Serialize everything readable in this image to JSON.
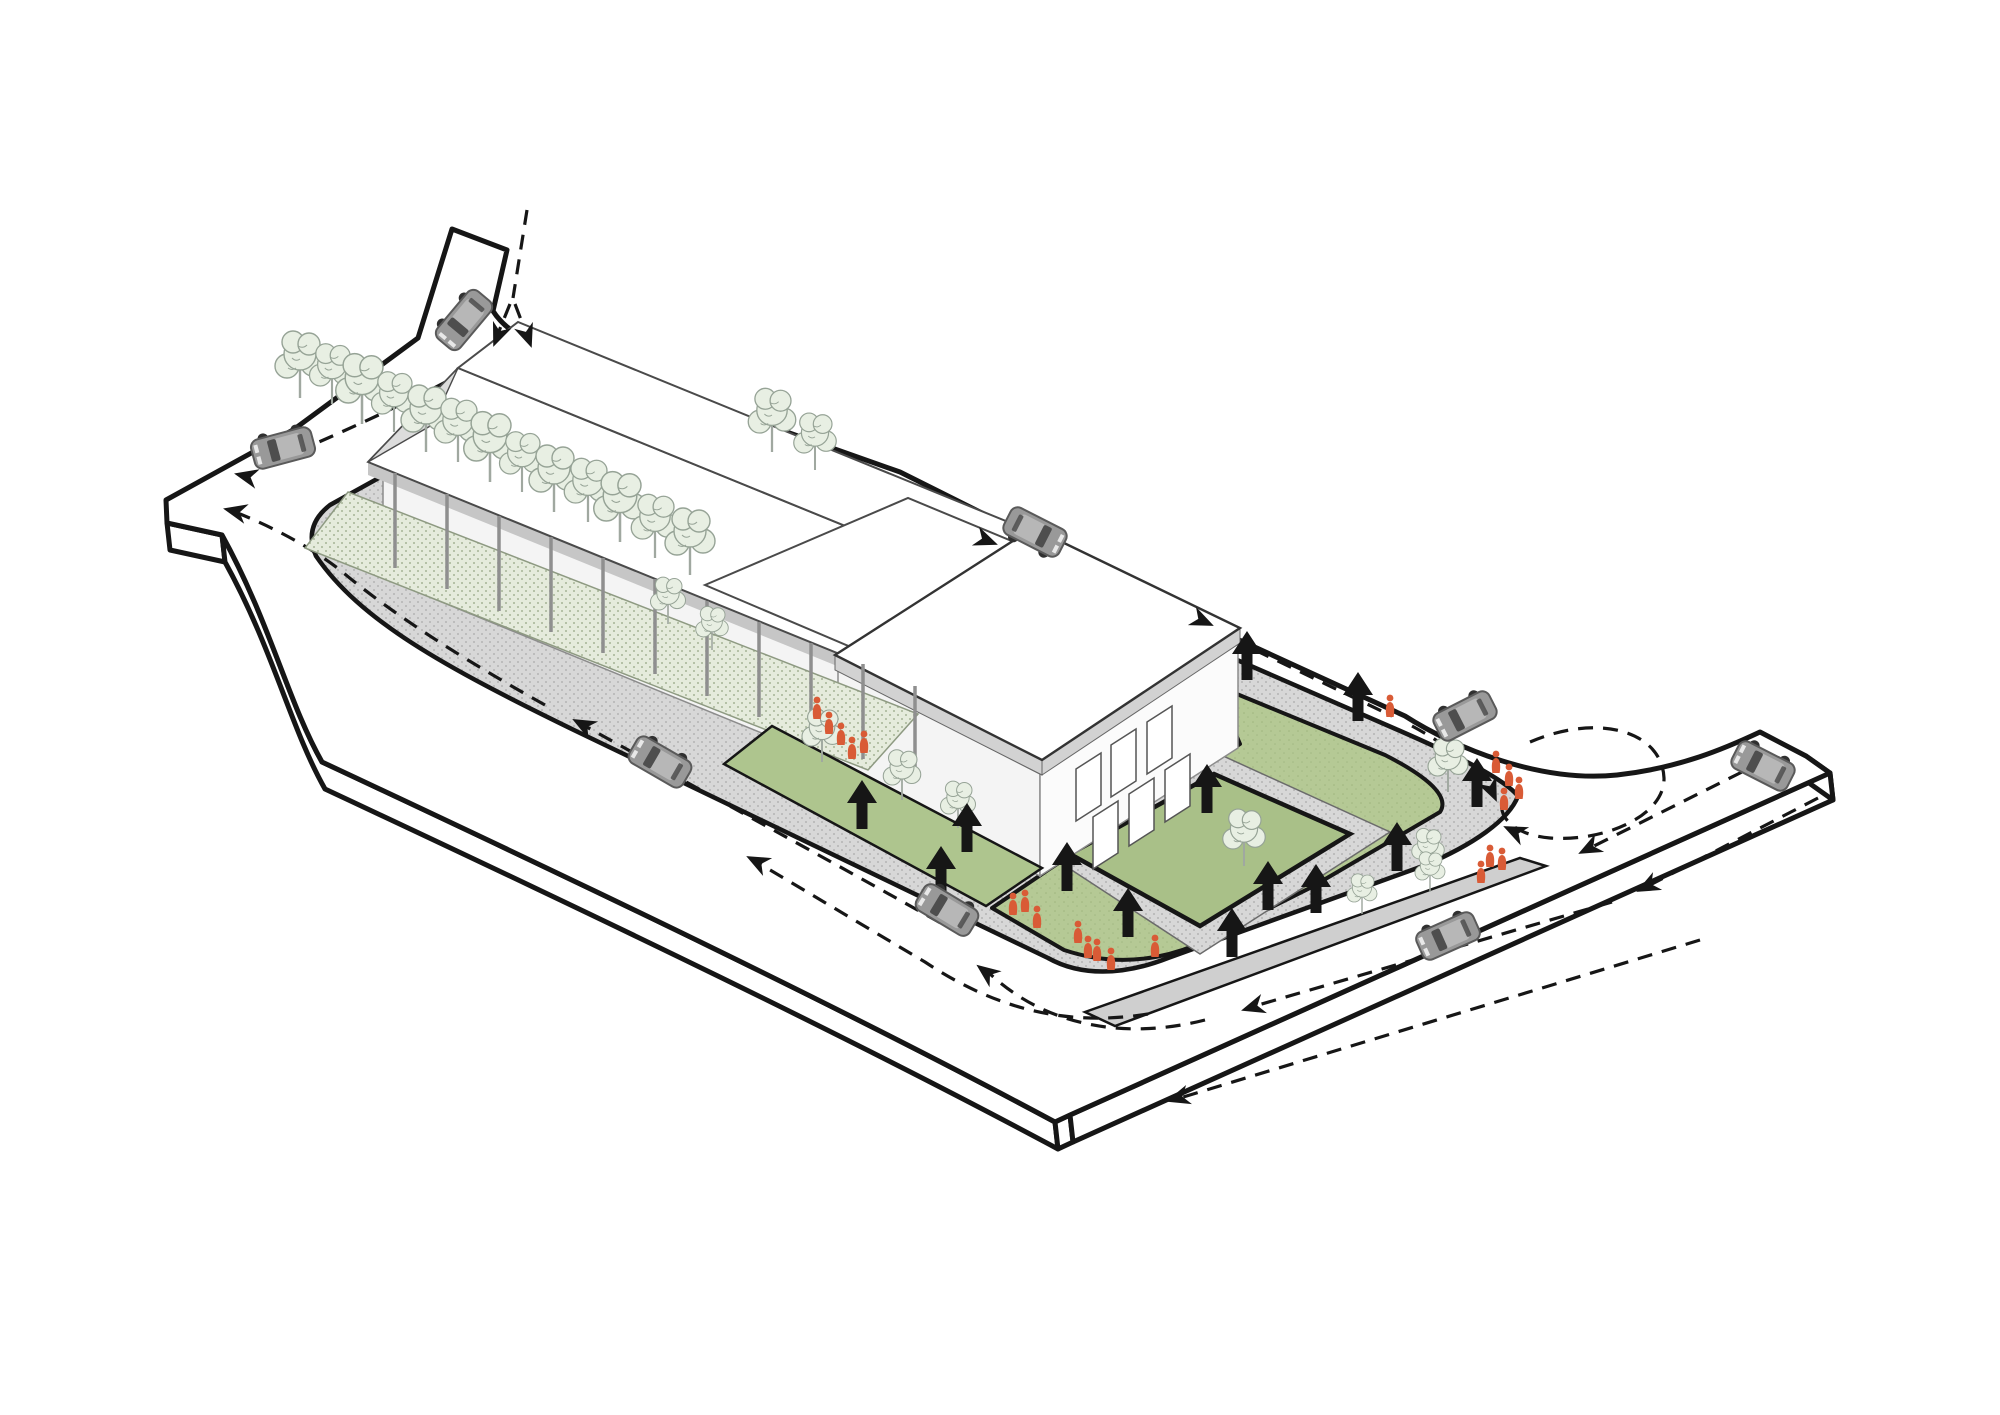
{
  "diagram": {
    "title": "site-circulation-axonometric-diagram",
    "type": "axonometric architectural site / circulation diagram",
    "background": "#ffffff"
  },
  "colors": {
    "ink": "#161616",
    "road": "#ffffff",
    "sidewalk": "#d7d7d7",
    "sidewalk_dot": "#a9a9a9",
    "plant_strip": "#e5ebdc",
    "plant_dot": "#a6b497",
    "lawn": "#b5c995",
    "lawn_inner": "#a9c088",
    "ramp": "#cdd7b9",
    "hedge": "#aec58e",
    "median": "#cfcfcf",
    "tree_fill": "#e8efe3",
    "tree_stroke": "#96a396",
    "trunk": "#a0a8a0",
    "building_line": "#4a4a4a",
    "glass": "#f4f4f4",
    "mullion": "#8c8c8c",
    "parapet": "#d2d2d2",
    "eave_shadow": "#c6c6c6",
    "roof_white": "#ffffff",
    "car_body": "#999999",
    "car_roof": "#b7b7b7",
    "car_glass": "#4e4e4e",
    "car_outline": "#5a5a5a",
    "wheel": "#303030",
    "people": "#d95b36",
    "arrow": "#161616"
  },
  "entities": {
    "cars": [
      {
        "x": 464,
        "y": 320,
        "angle": 130
      },
      {
        "x": 283,
        "y": 448,
        "angle": 165
      },
      {
        "x": 660,
        "y": 762,
        "angle": 210
      },
      {
        "x": 947,
        "y": 910,
        "angle": 211
      },
      {
        "x": 1035,
        "y": 532,
        "angle": 27
      },
      {
        "x": 1465,
        "y": 716,
        "angle": 153
      },
      {
        "x": 1763,
        "y": 766,
        "angle": 207
      },
      {
        "x": 1448,
        "y": 936,
        "angle": 156
      }
    ],
    "pedestrian_arrows": [
      {
        "x": 1247,
        "y": 657
      },
      {
        "x": 1358,
        "y": 698
      },
      {
        "x": 1477,
        "y": 784
      },
      {
        "x": 1397,
        "y": 848
      },
      {
        "x": 1316,
        "y": 890
      },
      {
        "x": 1268,
        "y": 887
      },
      {
        "x": 1232,
        "y": 934
      },
      {
        "x": 1128,
        "y": 914
      },
      {
        "x": 1067,
        "y": 868
      },
      {
        "x": 1207,
        "y": 790
      },
      {
        "x": 967,
        "y": 829
      },
      {
        "x": 941,
        "y": 872
      },
      {
        "x": 862,
        "y": 806
      }
    ],
    "people": [
      {
        "x": 817,
        "y": 712
      },
      {
        "x": 829,
        "y": 727
      },
      {
        "x": 841,
        "y": 738
      },
      {
        "x": 852,
        "y": 752
      },
      {
        "x": 864,
        "y": 746
      },
      {
        "x": 1013,
        "y": 908
      },
      {
        "x": 1025,
        "y": 905
      },
      {
        "x": 1037,
        "y": 921
      },
      {
        "x": 1078,
        "y": 936
      },
      {
        "x": 1088,
        "y": 951
      },
      {
        "x": 1097,
        "y": 954
      },
      {
        "x": 1111,
        "y": 963
      },
      {
        "x": 1496,
        "y": 766
      },
      {
        "x": 1509,
        "y": 779
      },
      {
        "x": 1504,
        "y": 803
      },
      {
        "x": 1519,
        "y": 792
      },
      {
        "x": 1390,
        "y": 710
      },
      {
        "x": 1490,
        "y": 860
      },
      {
        "x": 1502,
        "y": 863
      },
      {
        "x": 1481,
        "y": 876
      },
      {
        "x": 1155,
        "y": 950
      }
    ],
    "trees": [
      {
        "x": 300,
        "y": 398,
        "s": 1.0
      },
      {
        "x": 332,
        "y": 404,
        "s": 0.9
      },
      {
        "x": 362,
        "y": 424,
        "s": 1.05
      },
      {
        "x": 394,
        "y": 432,
        "s": 0.9
      },
      {
        "x": 426,
        "y": 452,
        "s": 1.0
      },
      {
        "x": 458,
        "y": 462,
        "s": 0.95
      },
      {
        "x": 490,
        "y": 482,
        "s": 1.05
      },
      {
        "x": 522,
        "y": 492,
        "s": 0.9
      },
      {
        "x": 554,
        "y": 512,
        "s": 1.0
      },
      {
        "x": 588,
        "y": 522,
        "s": 0.95
      },
      {
        "x": 620,
        "y": 542,
        "s": 1.05
      },
      {
        "x": 655,
        "y": 558,
        "s": 0.95
      },
      {
        "x": 690,
        "y": 575,
        "s": 1.0
      },
      {
        "x": 772,
        "y": 452,
        "s": 0.95
      },
      {
        "x": 815,
        "y": 470,
        "s": 0.85
      },
      {
        "x": 668,
        "y": 624,
        "s": 0.7
      },
      {
        "x": 712,
        "y": 650,
        "s": 0.65
      },
      {
        "x": 822,
        "y": 762,
        "s": 0.8
      },
      {
        "x": 902,
        "y": 800,
        "s": 0.75
      },
      {
        "x": 958,
        "y": 828,
        "s": 0.7
      },
      {
        "x": 1244,
        "y": 866,
        "s": 0.85
      },
      {
        "x": 1448,
        "y": 792,
        "s": 0.8
      },
      {
        "x": 1428,
        "y": 872,
        "s": 0.65
      },
      {
        "x": 1362,
        "y": 914,
        "s": 0.6
      },
      {
        "x": 1430,
        "y": 892,
        "s": 0.6
      }
    ],
    "flow_arrowheads": [
      {
        "x": 494,
        "y": 345,
        "angle": 112
      },
      {
        "x": 531,
        "y": 346,
        "angle": 70
      },
      {
        "x": 236,
        "y": 474,
        "angle": 193
      },
      {
        "x": 996,
        "y": 544,
        "angle": 21
      },
      {
        "x": 1212,
        "y": 625,
        "angle": 24
      },
      {
        "x": 1496,
        "y": 800,
        "angle": 66
      },
      {
        "x": 1505,
        "y": 827,
        "angle": 205
      },
      {
        "x": 1580,
        "y": 853,
        "angle": 153
      },
      {
        "x": 1638,
        "y": 891,
        "angle": 153
      },
      {
        "x": 1243,
        "y": 1010,
        "angle": 163
      },
      {
        "x": 978,
        "y": 966,
        "angle": 217
      },
      {
        "x": 574,
        "y": 720,
        "angle": 208
      },
      {
        "x": 225,
        "y": 509,
        "angle": 193
      },
      {
        "x": 748,
        "y": 857,
        "angle": 207
      },
      {
        "x": 1168,
        "y": 1101,
        "angle": 163
      }
    ]
  }
}
